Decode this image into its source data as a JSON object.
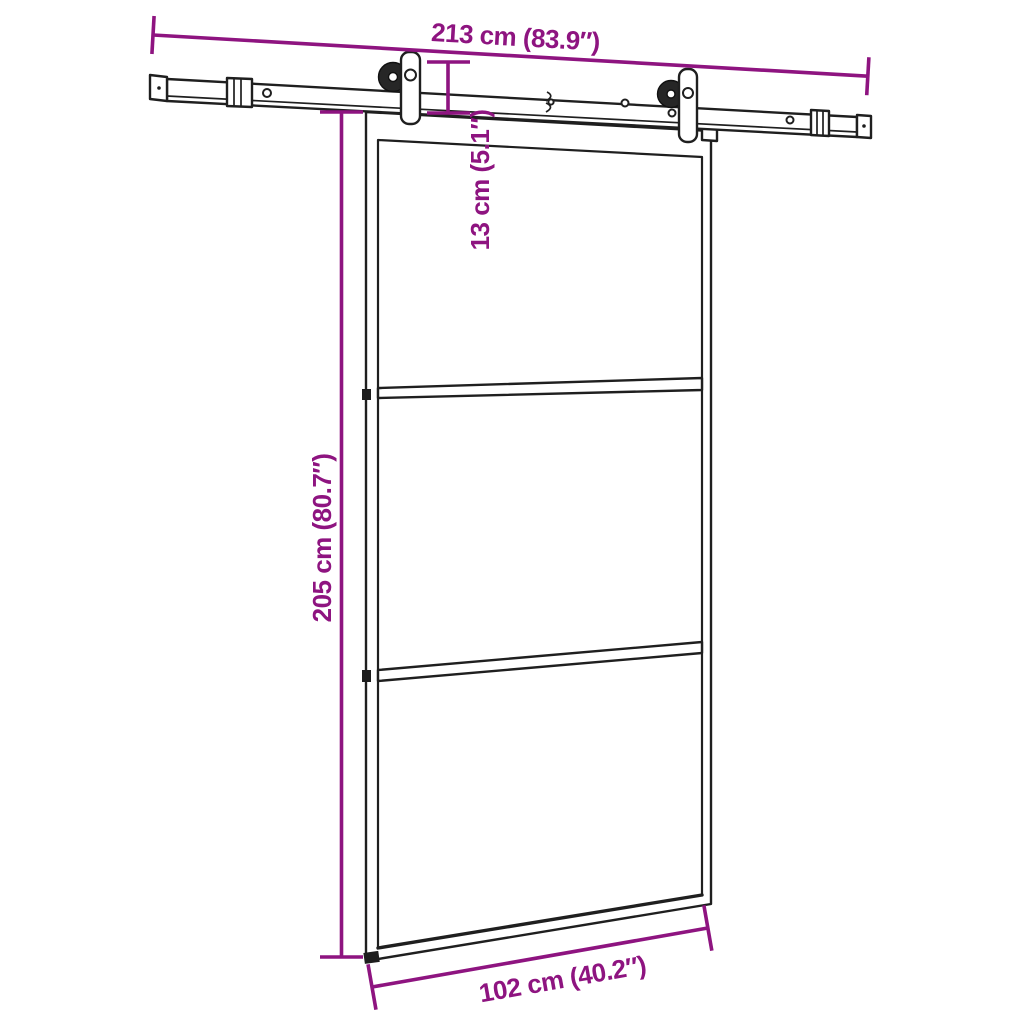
{
  "figure": {
    "title": "Sliding door with hardware set — dimension diagram",
    "type": "product-dimension-diagram",
    "glass_panels": 3
  },
  "colors": {
    "accent": "#8E1480",
    "line": "#1f1f1f",
    "background": "#ffffff"
  },
  "dimensions": {
    "rail_width": {
      "label": "213 cm (83.9″)",
      "value_cm": 213,
      "value_in": 83.9
    },
    "drop": {
      "label": "13 cm (5.1″)",
      "value_cm": 13,
      "value_in": 5.1
    },
    "door_height": {
      "label": "205 cm (80.7″)",
      "value_cm": 205,
      "value_in": 80.7
    },
    "door_width": {
      "label": "102 cm (40.2″)",
      "value_cm": 102,
      "value_in": 40.2
    }
  }
}
